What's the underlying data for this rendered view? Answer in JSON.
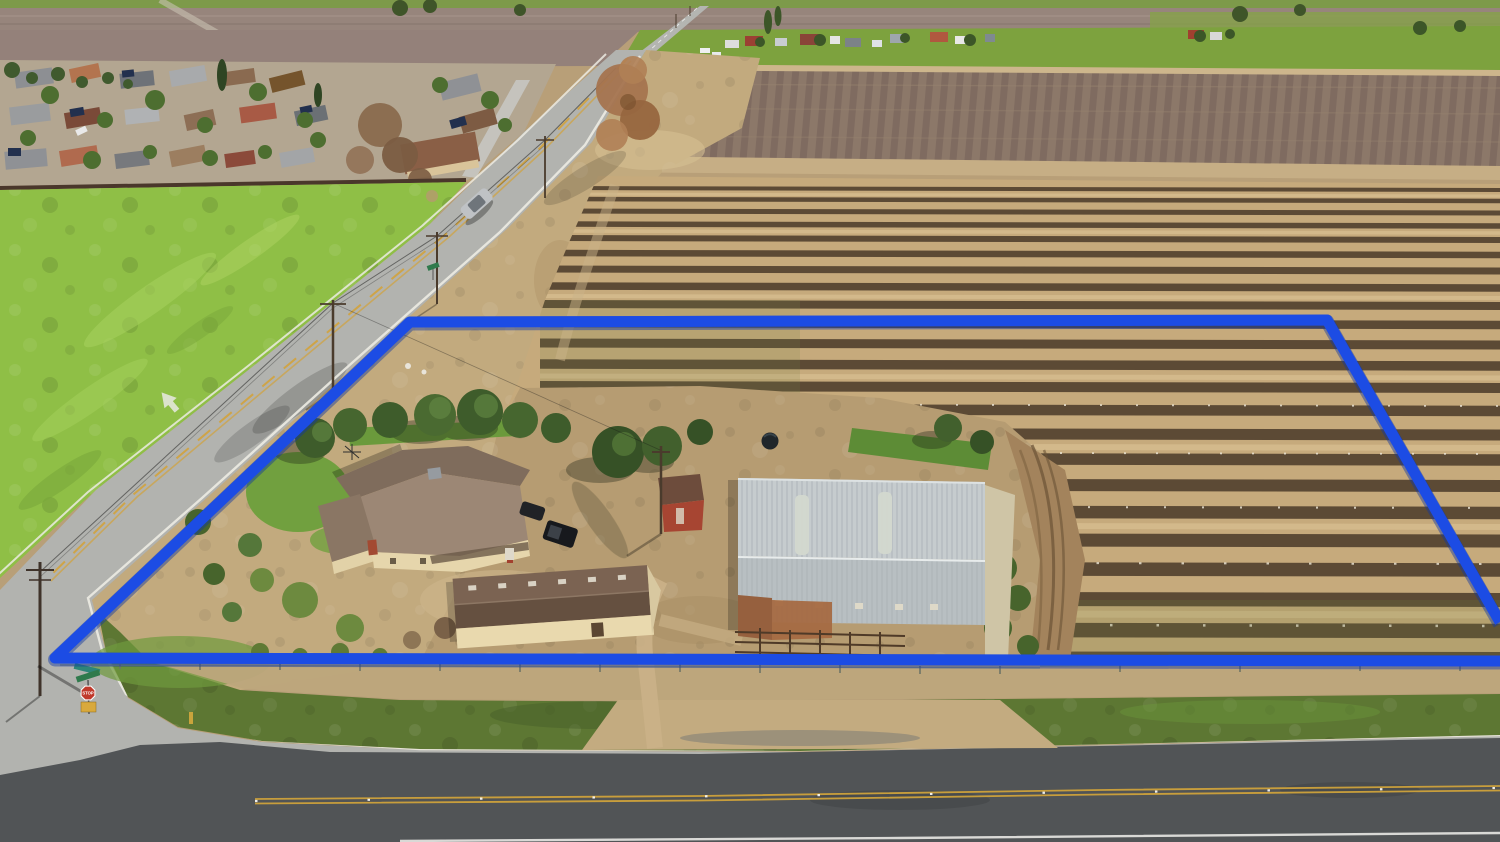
{
  "meta": {
    "title": "Aerial property photograph",
    "description": "Drone aerial photo of a rural homestead outlined with a blue property boundary, bordered by a country road and a highway, surrounded by dormant vineyard rows, almond orchards, a green pasture and a residential neighborhood."
  },
  "boundary": {
    "color": "#1c4ce4",
    "outline_color": "#12379f"
  },
  "signs": {
    "stop_label": "STOP"
  },
  "landscape": {
    "pasture_color": "#8fbf46",
    "vineyard_soil": "#c6aa7c",
    "vine_row_color": "#443526",
    "orchard_color": "#8c7869",
    "grass_verge": "#5d7733"
  },
  "roads": {
    "country_road_color": "#b2b3af",
    "highway_color": "#515456",
    "center_line_yellow": "#d2a23c",
    "edge_line_white": "#ecebe3"
  },
  "homestead": {
    "barn_roof": "#c6ccce",
    "house_roof": "#9c8775",
    "house_wall": "#e6d6ac",
    "outbuilding_roof": "#7b6352",
    "shed_wall": "#a74532",
    "lawn": "#71a03f"
  }
}
